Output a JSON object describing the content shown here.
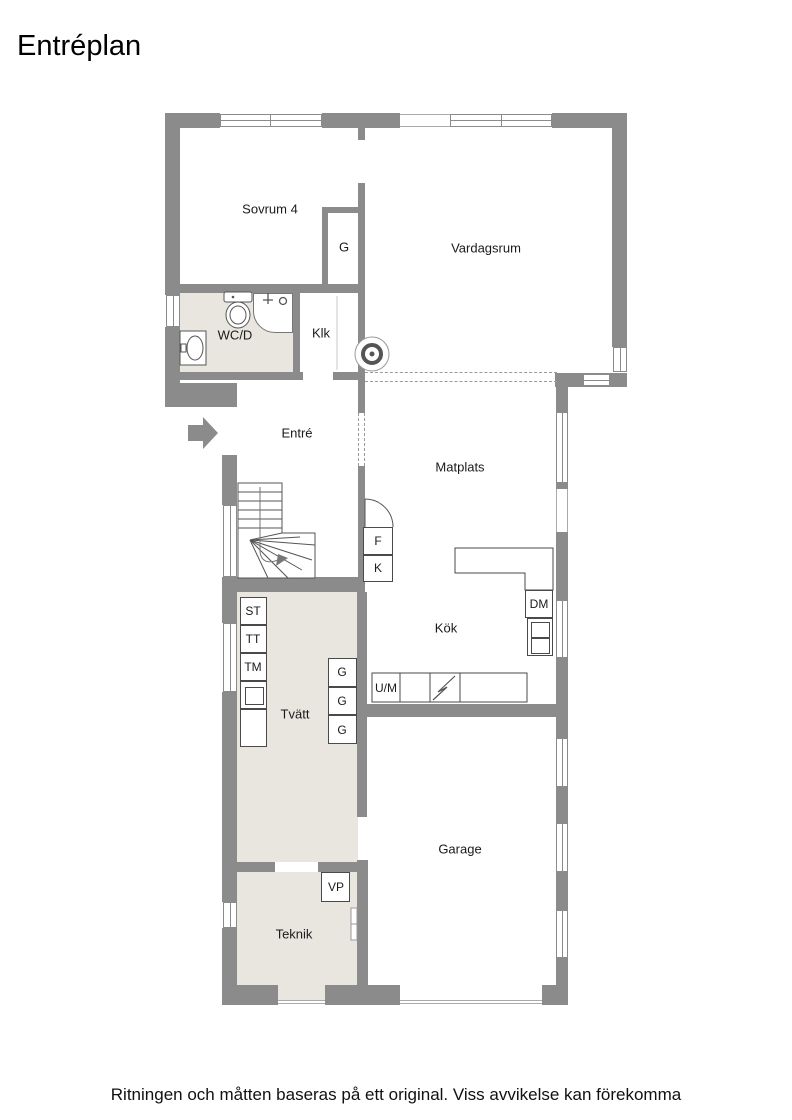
{
  "page": {
    "title": "Entréplan",
    "disclaimer": "Ritningen och måtten baseras på ett original. Viss avvikelse kan förekomma"
  },
  "colors": {
    "wall": "#8b8b8b",
    "floor_light": "#e9e6e0",
    "outline": "#4a4a4a",
    "dashed_line": "#9a9a9a"
  },
  "floorplan": {
    "rooms": [
      {
        "id": "sovrum4",
        "label": "Sovrum 4"
      },
      {
        "id": "vardagsrum",
        "label": "Vardagsrum"
      },
      {
        "id": "wcd",
        "label": "WC/D"
      },
      {
        "id": "klk",
        "label": "Klk"
      },
      {
        "id": "entre",
        "label": "Entré"
      },
      {
        "id": "matplats",
        "label": "Matplats"
      },
      {
        "id": "kok",
        "label": "Kök"
      },
      {
        "id": "tvatt",
        "label": "Tvätt"
      },
      {
        "id": "garage",
        "label": "Garage"
      },
      {
        "id": "teknik",
        "label": "Teknik"
      }
    ],
    "fixtures": [
      {
        "id": "g-sovrum",
        "label": "G"
      },
      {
        "id": "fridge",
        "label": "F"
      },
      {
        "id": "freezer",
        "label": "K"
      },
      {
        "id": "dishwasher",
        "label": "DM"
      },
      {
        "id": "oven-micro",
        "label": "U/M"
      },
      {
        "id": "cleaning",
        "label": "ST"
      },
      {
        "id": "dryer",
        "label": "TT"
      },
      {
        "id": "washer",
        "label": "TM"
      },
      {
        "id": "closet-1",
        "label": "G"
      },
      {
        "id": "closet-2",
        "label": "G"
      },
      {
        "id": "closet-3",
        "label": "G"
      },
      {
        "id": "heat-pump",
        "label": "VP"
      }
    ]
  }
}
